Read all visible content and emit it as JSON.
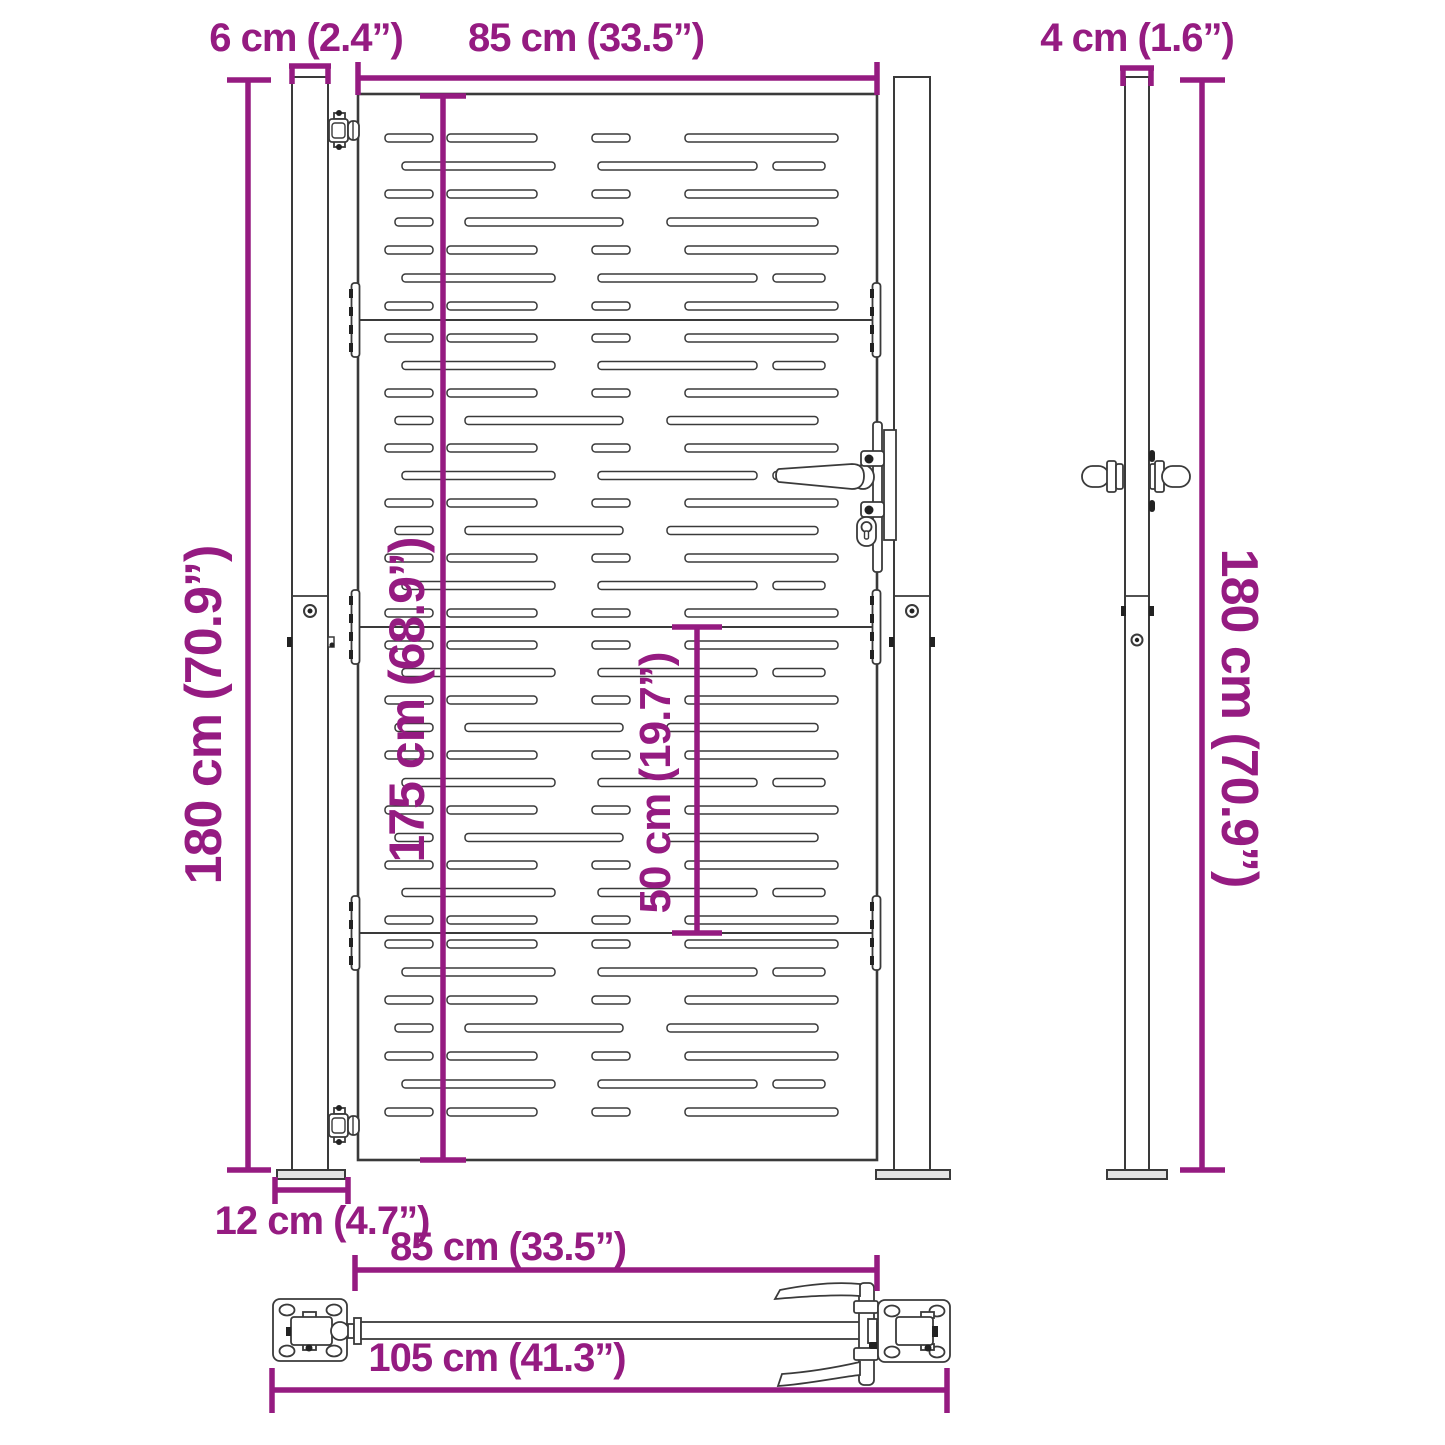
{
  "title": "Garden gate dimension diagram",
  "colors": {
    "dimension": "#951b81",
    "line": "#3a3a3a"
  },
  "dimensions": {
    "post_width_front": "6 cm (2.4”)",
    "gate_width_top": "85 cm (33.5”)",
    "post_width_side": "4 cm (1.6”)",
    "post_height_left": "180 cm (70.9”)",
    "gate_height": "175 cm (68.9”)",
    "panel_height": "50 cm (19.7”)",
    "post_height_right": "180 cm (70.9”)",
    "base_plate_width": "12 cm (4.7”)",
    "gate_width_bottom": "85 cm (33.5”)",
    "total_width": "105 cm (41.3”)"
  },
  "gate": {
    "slot_patterns": {
      "A": [
        [
          385,
          48
        ],
        [
          447,
          90
        ],
        [
          592,
          38
        ],
        [
          685,
          153
        ]
      ],
      "B": [
        [
          402,
          153
        ],
        [
          598,
          159
        ],
        [
          773,
          52
        ]
      ],
      "C": [
        [
          395,
          38
        ],
        [
          465,
          158
        ],
        [
          667,
          151
        ]
      ]
    },
    "panels": [
      {
        "first_row_y": 138,
        "row_spacing": 28,
        "rows": [
          "A",
          "B",
          "A",
          "C",
          "A",
          "B",
          "A"
        ]
      },
      {
        "first_row_y": 338,
        "row_spacing": 27.5,
        "rows": [
          "A",
          "B",
          "A",
          "C",
          "A",
          "B",
          "A",
          "C",
          "A",
          "B",
          "A"
        ]
      },
      {
        "first_row_y": 645,
        "row_spacing": 27.5,
        "rows": [
          "A",
          "B",
          "A",
          "C",
          "A",
          "B",
          "A",
          "C",
          "A",
          "B",
          "A"
        ]
      },
      {
        "first_row_y": 944,
        "row_spacing": 28,
        "rows": [
          "A",
          "B",
          "A",
          "C",
          "A",
          "B",
          "A"
        ]
      }
    ],
    "seam_ys": [
      320,
      627,
      933
    ]
  }
}
